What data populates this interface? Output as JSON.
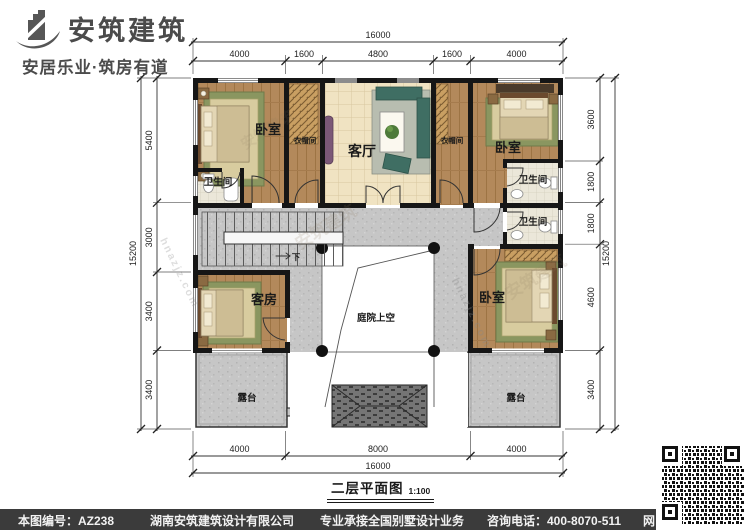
{
  "brand": {
    "name": "安筑建筑",
    "tagline": "安居乐业·筑房有道"
  },
  "title": {
    "text": "二层平面图",
    "scale": "1:100"
  },
  "footer": {
    "plan_no": "本图编号：AZ238",
    "company": "湖南安筑建筑设计有限公司",
    "service": "专业承接全国别墅设计业务",
    "phone": "咨询电话：400-8070-511",
    "web": "网"
  },
  "rooms": {
    "bedroom": "卧室",
    "living": "客厅",
    "cloakroom": "衣帽间",
    "bathroom": "卫生间",
    "guest": "客房",
    "terrace": "露台",
    "courtyard": "庭院上空",
    "down": "下"
  },
  "dims": {
    "top_total": "16000",
    "top": [
      "4000",
      "1600",
      "4800",
      "1600",
      "4000"
    ],
    "bottom": [
      "4000",
      "8000",
      "4000"
    ],
    "bottom_total": "16000",
    "left": [
      "5400",
      "3000",
      "3400",
      "3400"
    ],
    "left_total": "15200",
    "right": [
      "3600",
      "1800",
      "1800",
      "4600",
      "3400"
    ],
    "right_total": "15200"
  },
  "watermarks": {
    "brand": "安筑建筑",
    "site": "hnazjz.com"
  },
  "colors": {
    "wall": "#161616",
    "wood_floor": "#b3895b",
    "living_tile": "#f0e3c2",
    "hall_gray": "#c6c6c6",
    "rug_green": "#8a9660",
    "footer_bg": "#3b3b3b",
    "brand_text": "#4b4b4b"
  }
}
